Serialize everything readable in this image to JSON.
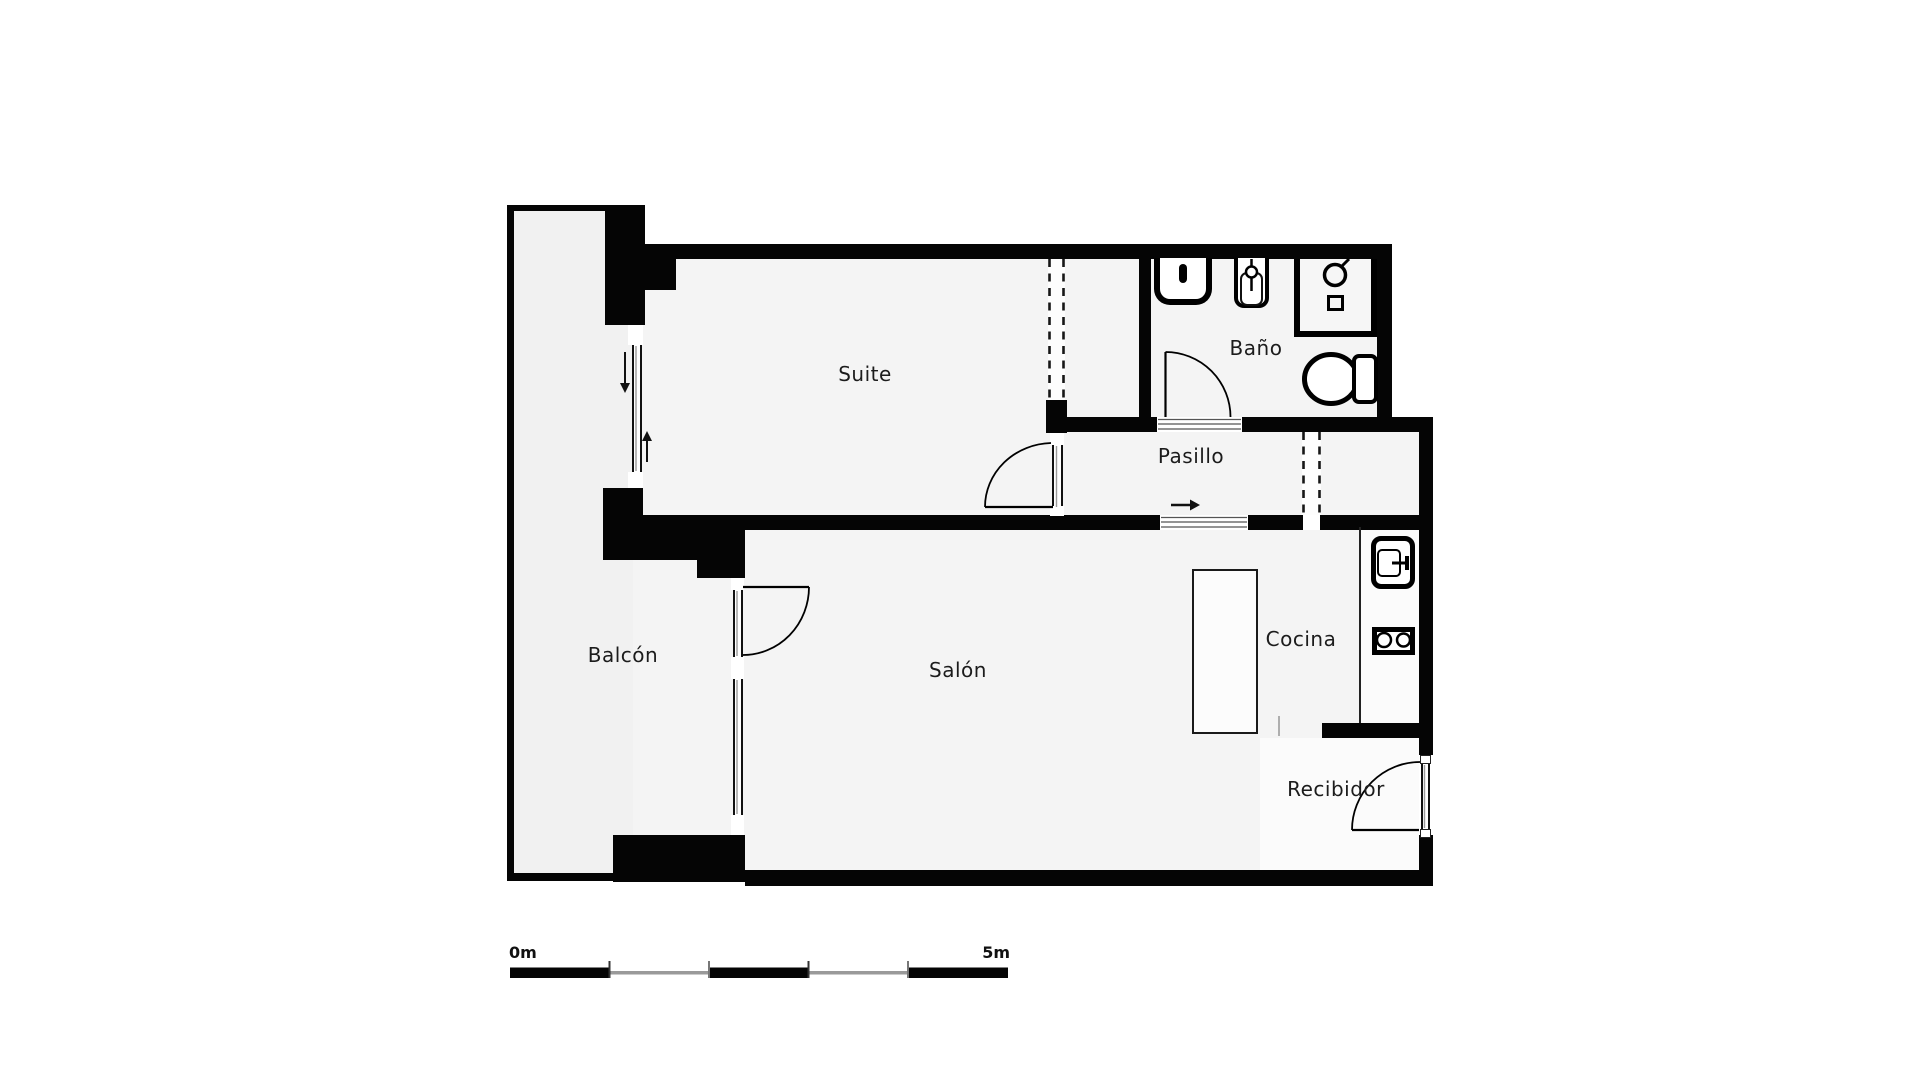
{
  "plan": {
    "type": "apartment-floorplan",
    "rooms": [
      {
        "key": "suite",
        "label": "Suite"
      },
      {
        "key": "bano",
        "label": "Baño"
      },
      {
        "key": "pasillo",
        "label": "Pasillo"
      },
      {
        "key": "balcon",
        "label": "Balcón"
      },
      {
        "key": "salon",
        "label": "Salón"
      },
      {
        "key": "cocina",
        "label": "Cocina"
      },
      {
        "key": "recibidor",
        "label": "Recibidor"
      }
    ],
    "scale_bar": {
      "start_label": "0m",
      "end_label": "5m",
      "segments": 5,
      "meters_total": 5
    },
    "colors": {
      "wall": "#050505",
      "floor": "#f4f4f4",
      "floor_light": "#fbfbfb",
      "scale_gray": "#9a9a9a",
      "text": "#1c1c1c"
    }
  }
}
